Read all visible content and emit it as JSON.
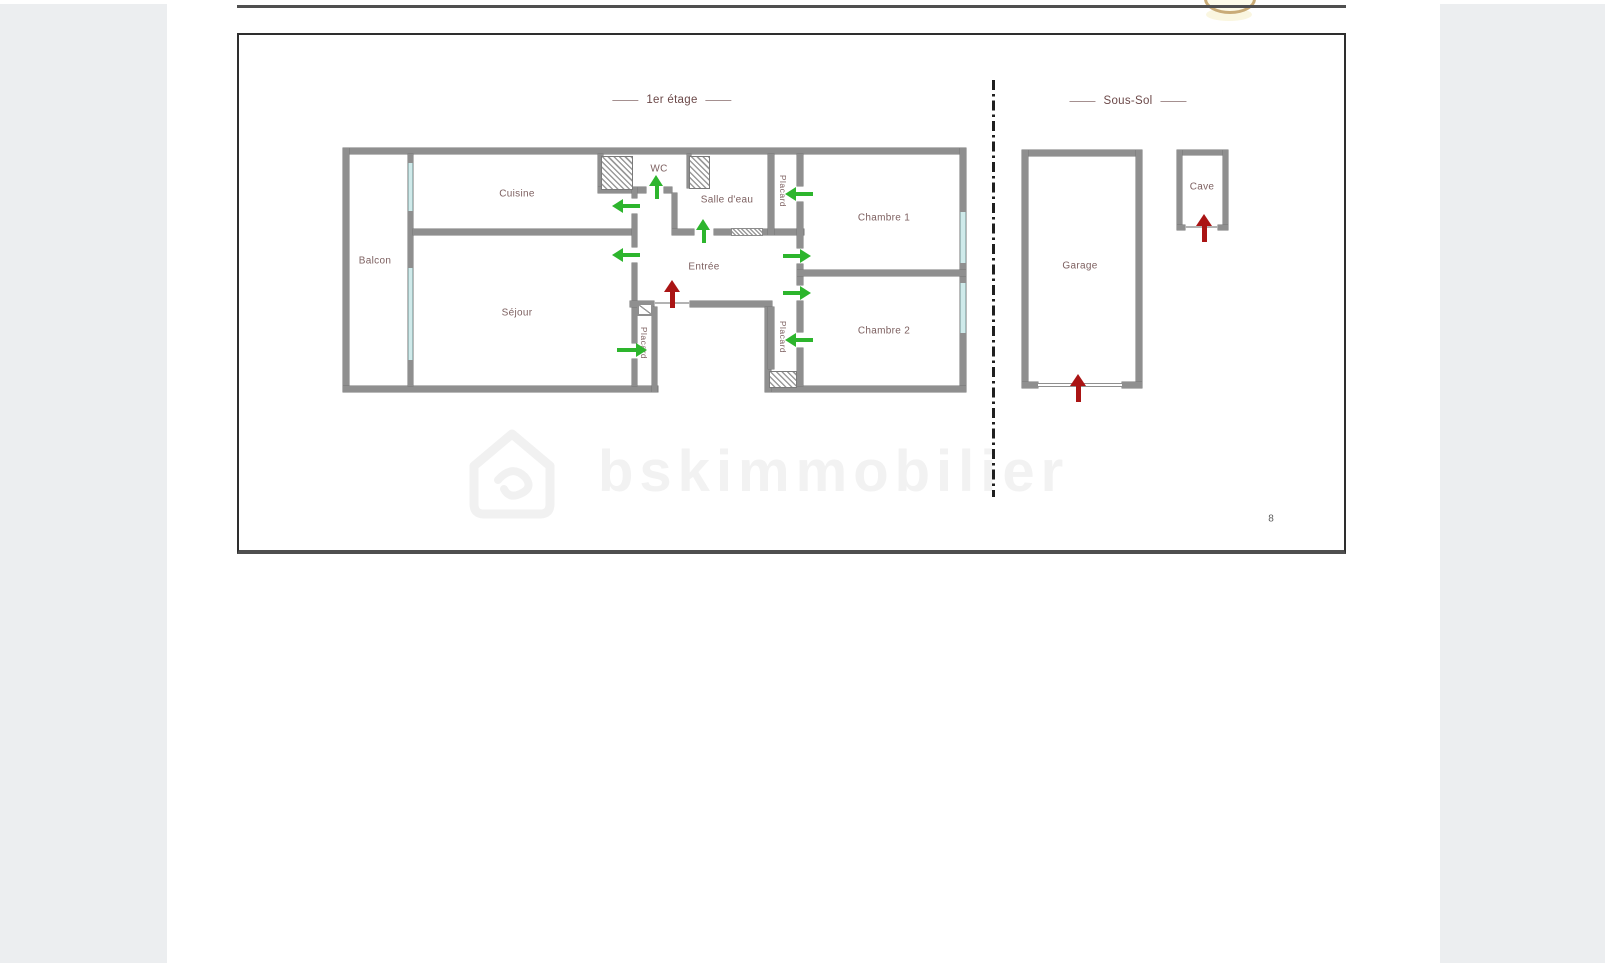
{
  "document": {
    "page_number": "8",
    "watermark": {
      "text": "bskimmobilier"
    }
  },
  "floor_plan": {
    "sections": [
      {
        "title": "1er étage"
      },
      {
        "title": "Sous-Sol"
      }
    ],
    "rooms": [
      {
        "label": "Balcon"
      },
      {
        "label": "Cuisine"
      },
      {
        "label": "Séjour"
      },
      {
        "label": "WC"
      },
      {
        "label": "Salle d'eau"
      },
      {
        "label": "Entrée"
      },
      {
        "label": "Chambre 1"
      },
      {
        "label": "Chambre 2"
      },
      {
        "label": "Garage"
      },
      {
        "label": "Cave"
      }
    ],
    "closets": [
      {
        "label": "Placard"
      },
      {
        "label": "Placard"
      },
      {
        "label": "Placard"
      }
    ]
  },
  "icons": {
    "interior_door_arrow": "green-arrow",
    "entrance_door_arrow": "red-arrow",
    "watermark_logo": "house-outline"
  },
  "colors": {
    "wall": "#8f8f8f",
    "wall_edge": "#757575",
    "window_glass": "#cfeaea",
    "hatch_line": "#9a9a9a",
    "room_label": "#7d6060",
    "section_title": "#6b4848",
    "divider_line": "#1f1f1f",
    "interior_arrow": "#2db52d",
    "entrance_arrow": "#aa1414",
    "watermark": "#f2f2f2",
    "page_bg": "#ffffff",
    "margin_bg": "#eceef0",
    "frame_border": "#2e2e2e",
    "frame_bottom": "#4f4f4f",
    "logo_gold": "#c9ab77"
  }
}
